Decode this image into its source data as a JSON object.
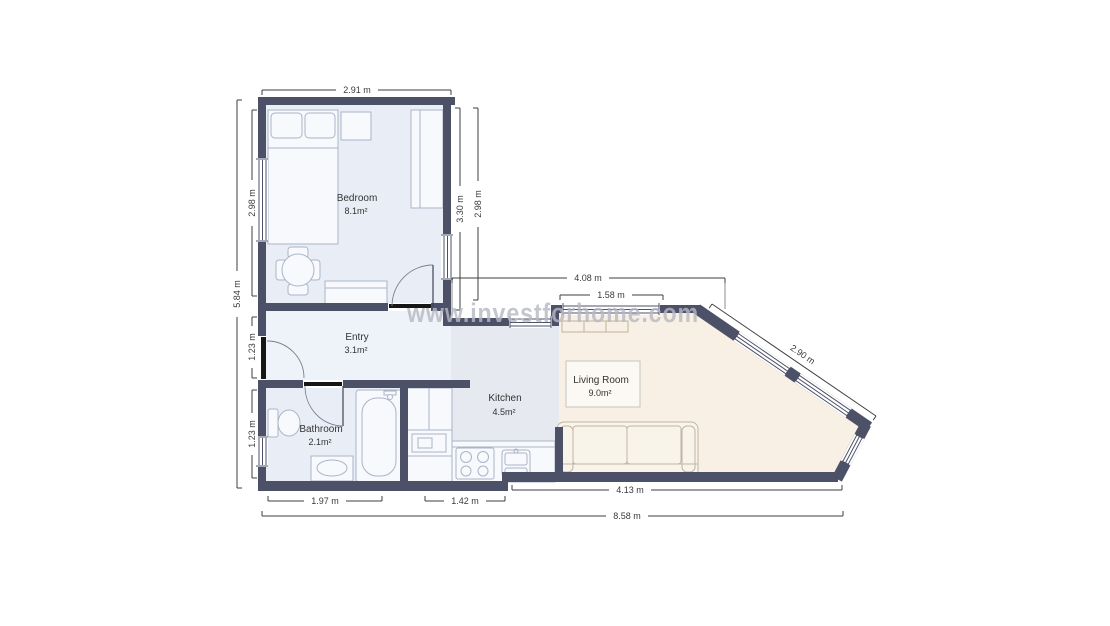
{
  "watermark": "www.investforhome.com",
  "rooms": [
    {
      "name": "Bedroom",
      "area": "8.1m²"
    },
    {
      "name": "Entry",
      "area": "3.1m²"
    },
    {
      "name": "Bathroom",
      "area": "2.1m²"
    },
    {
      "name": "Kitchen",
      "area": "4.5m²"
    },
    {
      "name": "Living Room",
      "area": "9.0m²"
    }
  ],
  "dimensions": {
    "top_width": "2.91 m",
    "left_total": "5.84 m",
    "left_bedroom": "2.98 m",
    "left_entry": "1.23 m",
    "left_bathroom": "1.23 m",
    "right_bedroom_inner": "3.30 m",
    "right_bedroom_outer": "2.98 m",
    "top_living": "4.08 m",
    "top_window": "1.58 m",
    "diagonal": "2.90 m",
    "bottom_bathroom": "1.97 m",
    "bottom_kitchen": "1.42 m",
    "bottom_living": "4.13 m",
    "bottom_total": "8.58 m"
  },
  "colors": {
    "wall": "#4d5168",
    "bedroom_floor": "#e9eef6",
    "entry_floor": "#eef2f9",
    "bathroom_floor": "#e9eef6",
    "kitchen_floor": "#e7e9f1",
    "living_floor": "#f8f0e4",
    "watermark": "#b6b8c2"
  }
}
